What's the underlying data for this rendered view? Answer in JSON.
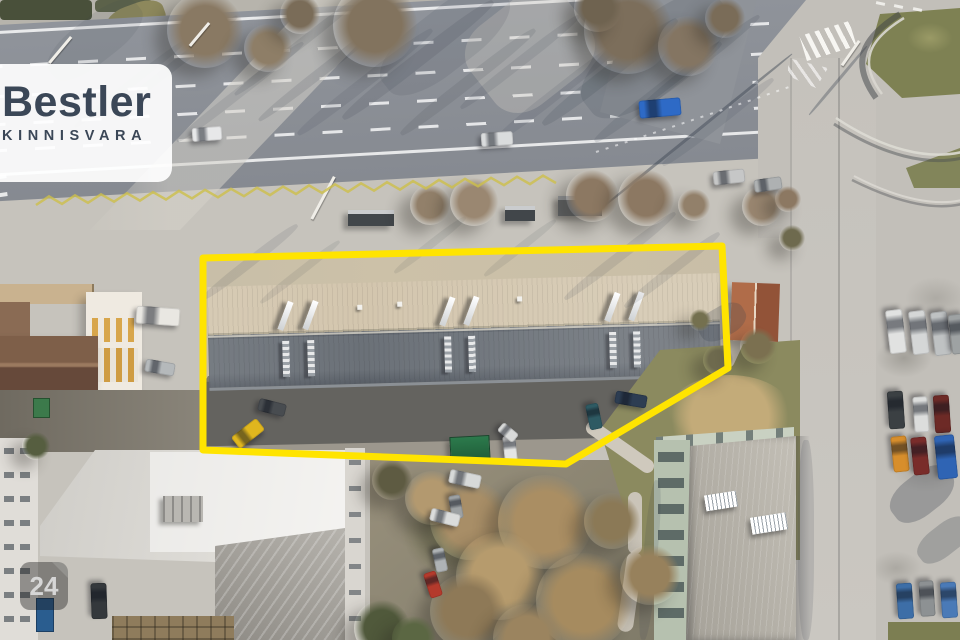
{
  "branding": {
    "logo_text": "Bestler",
    "logo_subtext": "KINNISVARA",
    "logo_color": "#3b4757",
    "panel_color": "rgba(255,255,255,0.92)"
  },
  "watermark": {
    "badge_text": "24",
    "badge_bg": "rgba(25,25,25,0.4)",
    "badge_text_color": "#d6d6d6"
  },
  "property_outline": {
    "color": "#ffe400",
    "stroke_width": 7,
    "points": "203,258 722,246 728,368 566,464 203,450"
  },
  "road_markings": {
    "zigzag": {
      "x1": 36,
      "y1": 205,
      "x2": 556,
      "y2": 183,
      "amp": 8,
      "step": 13,
      "color": "#cdbf4a"
    },
    "guide_arc_color": "#ffffff"
  },
  "scene": {
    "cars": [
      [
        207,
        134,
        30,
        14,
        -4,
        "#e7e8e9"
      ],
      [
        497,
        139,
        32,
        14,
        -4,
        "#dadcdd"
      ],
      [
        660,
        108,
        42,
        18,
        -5,
        "#2e6ac6"
      ],
      [
        729,
        177,
        32,
        14,
        -6,
        "#c6c7c7"
      ],
      [
        768,
        184,
        28,
        13,
        -8,
        "#aeb1b2"
      ],
      [
        248,
        433,
        32,
        15,
        -38,
        "#e0b61e"
      ],
      [
        272,
        407,
        28,
        13,
        14,
        "#484c50"
      ],
      [
        510,
        448,
        26,
        13,
        84,
        "#e4e5e4"
      ],
      [
        508,
        432,
        20,
        11,
        40,
        "#d9dad9"
      ],
      [
        631,
        399,
        32,
        13,
        10,
        "#2d3d52"
      ],
      [
        594,
        416,
        26,
        13,
        78,
        "#2e5a63"
      ],
      [
        158,
        316,
        44,
        18,
        4,
        "#e9e7e2"
      ],
      [
        160,
        367,
        30,
        13,
        10,
        "#b5b9bb"
      ],
      [
        465,
        479,
        32,
        14,
        12,
        "#d7d9d8"
      ],
      [
        456,
        507,
        24,
        12,
        80,
        "#9da1a3"
      ],
      [
        445,
        517,
        30,
        13,
        14,
        "#dbdcdb"
      ],
      [
        440,
        560,
        24,
        12,
        78,
        "#afb3b5"
      ],
      [
        433,
        584,
        26,
        13,
        72,
        "#b43a2c"
      ],
      [
        99,
        601,
        36,
        16,
        88,
        "#34383c"
      ],
      [
        896,
        331,
        44,
        17,
        83,
        "#e1e2e1"
      ],
      [
        919,
        332,
        44,
        17,
        83,
        "#d5d7d7"
      ],
      [
        941,
        333,
        44,
        17,
        83,
        "#bfc2c3"
      ],
      [
        958,
        334,
        40,
        16,
        83,
        "#9ea2a3"
      ],
      [
        896,
        410,
        38,
        16,
        86,
        "#3b4043"
      ],
      [
        921,
        414,
        36,
        15,
        86,
        "#dcdddc"
      ],
      [
        942,
        414,
        38,
        16,
        86,
        "#6d2a26"
      ],
      [
        900,
        454,
        36,
        16,
        84,
        "#d78e2c"
      ],
      [
        920,
        456,
        38,
        16,
        84,
        "#792c2a"
      ],
      [
        946,
        457,
        44,
        20,
        84,
        "#2f64b4"
      ],
      [
        905,
        601,
        36,
        16,
        86,
        "#3d6ea7"
      ],
      [
        927,
        598,
        36,
        15,
        86,
        "#8d9193"
      ],
      [
        949,
        600,
        36,
        16,
        86,
        "#4a7ab7"
      ]
    ],
    "trees": [
      [
        205,
        30,
        38,
        "#897963"
      ],
      [
        268,
        48,
        24,
        "#8e7e67"
      ],
      [
        375,
        25,
        42,
        "#82735e"
      ],
      [
        300,
        14,
        20,
        "#7a6c58"
      ],
      [
        628,
        30,
        44,
        "#7c6e5b"
      ],
      [
        688,
        46,
        30,
        "#847562"
      ],
      [
        598,
        8,
        24,
        "#6f6350"
      ],
      [
        725,
        18,
        20,
        "#7a6c58"
      ],
      [
        430,
        205,
        20,
        "#92806a"
      ],
      [
        474,
        202,
        24,
        "#9a8771"
      ],
      [
        592,
        196,
        26,
        "#8c7862"
      ],
      [
        646,
        198,
        28,
        "#8c7862"
      ],
      [
        694,
        205,
        16,
        "#92806a"
      ],
      [
        762,
        206,
        20,
        "#998670"
      ],
      [
        788,
        199,
        13,
        "#8c7862"
      ],
      [
        470,
        520,
        40,
        "#a88e67"
      ],
      [
        432,
        498,
        27,
        "#b3996f"
      ],
      [
        545,
        522,
        47,
        "#aa8e63"
      ],
      [
        500,
        576,
        44,
        "#b69b6d"
      ],
      [
        584,
        601,
        48,
        "#a68b5f"
      ],
      [
        468,
        611,
        38,
        "#8e7957"
      ],
      [
        527,
        638,
        34,
        "#9b845f"
      ],
      [
        612,
        521,
        28,
        "#8b7956"
      ],
      [
        650,
        575,
        30,
        "#97815c"
      ],
      [
        392,
        480,
        20,
        "#5e5b42"
      ],
      [
        382,
        628,
        28,
        "#50593b"
      ],
      [
        414,
        638,
        22,
        "#5b6743"
      ],
      [
        718,
        360,
        15,
        "#6e6a4e"
      ],
      [
        700,
        320,
        11,
        "#74704f"
      ],
      [
        758,
        346,
        18,
        "#7b7050"
      ],
      [
        792,
        238,
        13,
        "#6e6a4e"
      ],
      [
        36,
        446,
        14,
        "#565e40"
      ]
    ],
    "shadow_streaks": [
      [
        330,
        65,
        180,
        10,
        -38,
        0.14
      ],
      [
        365,
        82,
        170,
        12,
        -38,
        0.12
      ],
      [
        298,
        45,
        160,
        9,
        -38,
        0.13
      ],
      [
        418,
        60,
        190,
        14,
        -38,
        0.15
      ],
      [
        468,
        82,
        170,
        12,
        -38,
        0.13
      ],
      [
        520,
        62,
        150,
        10,
        -38,
        0.12
      ],
      [
        558,
        92,
        160,
        12,
        -38,
        0.12
      ],
      [
        610,
        72,
        170,
        14,
        -38,
        0.16
      ],
      [
        658,
        92,
        160,
        12,
        -38,
        0.15
      ],
      [
        700,
        62,
        150,
        10,
        -38,
        0.14
      ],
      [
        240,
        92,
        160,
        10,
        -38,
        0.12
      ],
      [
        178,
        62,
        150,
        9,
        -38,
        0.11
      ],
      [
        130,
        84,
        140,
        8,
        -38,
        0.1
      ],
      [
        718,
        122,
        140,
        10,
        -38,
        0.12
      ],
      [
        445,
        40,
        150,
        60,
        -38,
        0.12
      ],
      [
        655,
        55,
        170,
        70,
        -38,
        0.16
      ],
      [
        95,
        40,
        110,
        44,
        -38,
        0.1
      ],
      [
        250,
        262,
        120,
        10,
        -38,
        0.12
      ],
      [
        300,
        272,
        100,
        8,
        -38,
        0.1
      ],
      [
        620,
        256,
        140,
        10,
        -38,
        0.12
      ],
      [
        672,
        270,
        120,
        10,
        -38,
        0.12
      ],
      [
        430,
        245,
        90,
        8,
        -38,
        0.1
      ],
      [
        520,
        248,
        90,
        8,
        -38,
        0.1
      ],
      [
        695,
        132,
        250,
        3,
        -39,
        0.45
      ],
      [
        838,
        80,
        90,
        3,
        -50,
        0.35
      ],
      [
        922,
        494,
        70,
        40,
        -38,
        0.3
      ],
      [
        944,
        540,
        60,
        30,
        -38,
        0.25
      ],
      [
        806,
        540,
        16,
        200,
        0,
        0.15
      ],
      [
        650,
        560,
        14,
        160,
        5,
        0.15
      ],
      [
        722,
        322,
        50,
        30,
        -30,
        0.25
      ]
    ],
    "poles": [
      [
        70,
        36,
        34,
        40
      ],
      [
        333,
        176,
        48,
        28
      ],
      [
        858,
        40,
        30,
        35
      ],
      [
        208,
        22,
        30,
        40
      ]
    ]
  }
}
